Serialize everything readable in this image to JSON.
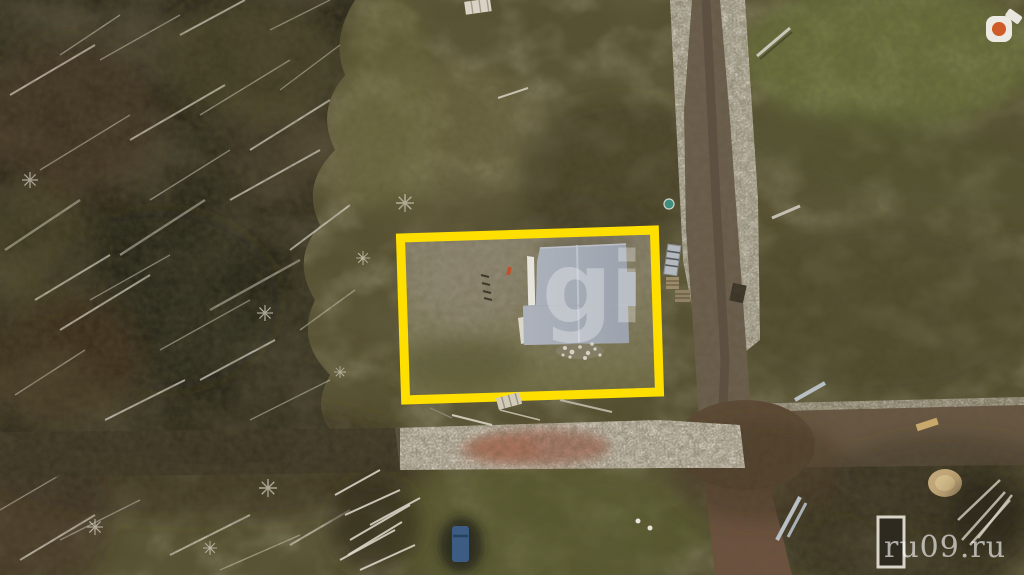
{
  "watermarks": {
    "center_text": "gi",
    "site_text": "ru09.ru"
  },
  "plot_highlight": {
    "color": "#ffdf00",
    "border_px": 9
  },
  "colors": {
    "roof": "#a6acb6",
    "teal_object": "#418c7c",
    "watermark": "#ffffff",
    "road_gravel": "#b2a897",
    "road_dirt": "#6e5f4e",
    "field_olive": "#56512f",
    "forest_dark": "#2f2b1d"
  }
}
